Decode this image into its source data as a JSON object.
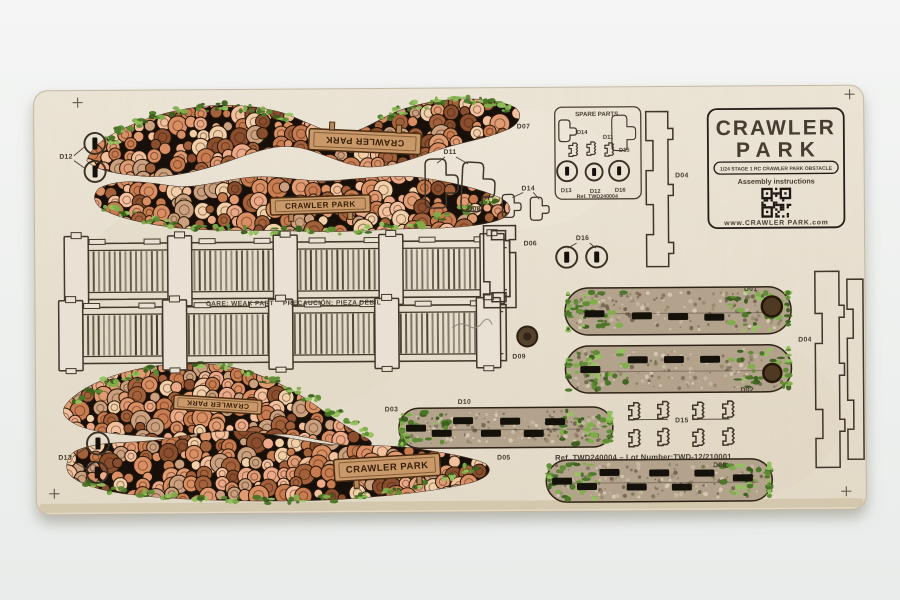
{
  "photo": {
    "description": "Laser-cut plywood model kit sheet on light background",
    "background": "#f0f2f1",
    "board": "#e9e2d4"
  },
  "palette": {
    "logs": [
      "#eba987",
      "#f3c09d",
      "#d98f63",
      "#c77b4f",
      "#f0cfa9",
      "#a2613b",
      "#8a4e2e",
      "#e09b72",
      "#caa07e"
    ],
    "grass": [
      "#7fae4a",
      "#5d8c33",
      "#4a7527",
      "#94c25e",
      "#3a5f1e"
    ],
    "gravel": [
      "#95876f",
      "#c9bba3",
      "#7e7059",
      "#d9ccb5",
      "#6d5f4a"
    ],
    "dirt": "#b3a38d",
    "cut_line": "#43382b",
    "pile_bg": "#17100a",
    "sign_wood": "#c9996a",
    "ink": "#453c31"
  },
  "branding": {
    "logo_line1": "CRAWLER",
    "logo_line2": "PARK",
    "badge": "1/24 STAGE 1 RC CRAWLER PARK OBSTACLE",
    "assembly": "Assembly instructions",
    "website": "www.CRAWLER PARK.com"
  },
  "sign": {
    "text": "CRAWLER PARK"
  },
  "spare_box": {
    "title": "SPARE PARTS",
    "ref": "Ref. TWD240004",
    "d14": "D14",
    "d11": "D11",
    "d15": "D15",
    "d13": "D13",
    "d12": "D12",
    "d16": "D16"
  },
  "labels": {
    "d01": "D01",
    "d02": "D02",
    "d03": "D03",
    "d04": "D04",
    "d05": "D05",
    "d06": "D06",
    "d07": "D07",
    "d08": "D08",
    "d09": "D09",
    "d10": "D10",
    "d11": "D11",
    "d12": "D12",
    "d13": "D13",
    "d14": "D14",
    "d15": "D15",
    "d16": "D16"
  },
  "warning": {
    "en": "CARE: WEAK PART",
    "es": "PRECAUCIÓN: PIEZA DÉBIL"
  },
  "ref_line": "Ref. TWD240004 – Lot Number:TWD-12/210001"
}
